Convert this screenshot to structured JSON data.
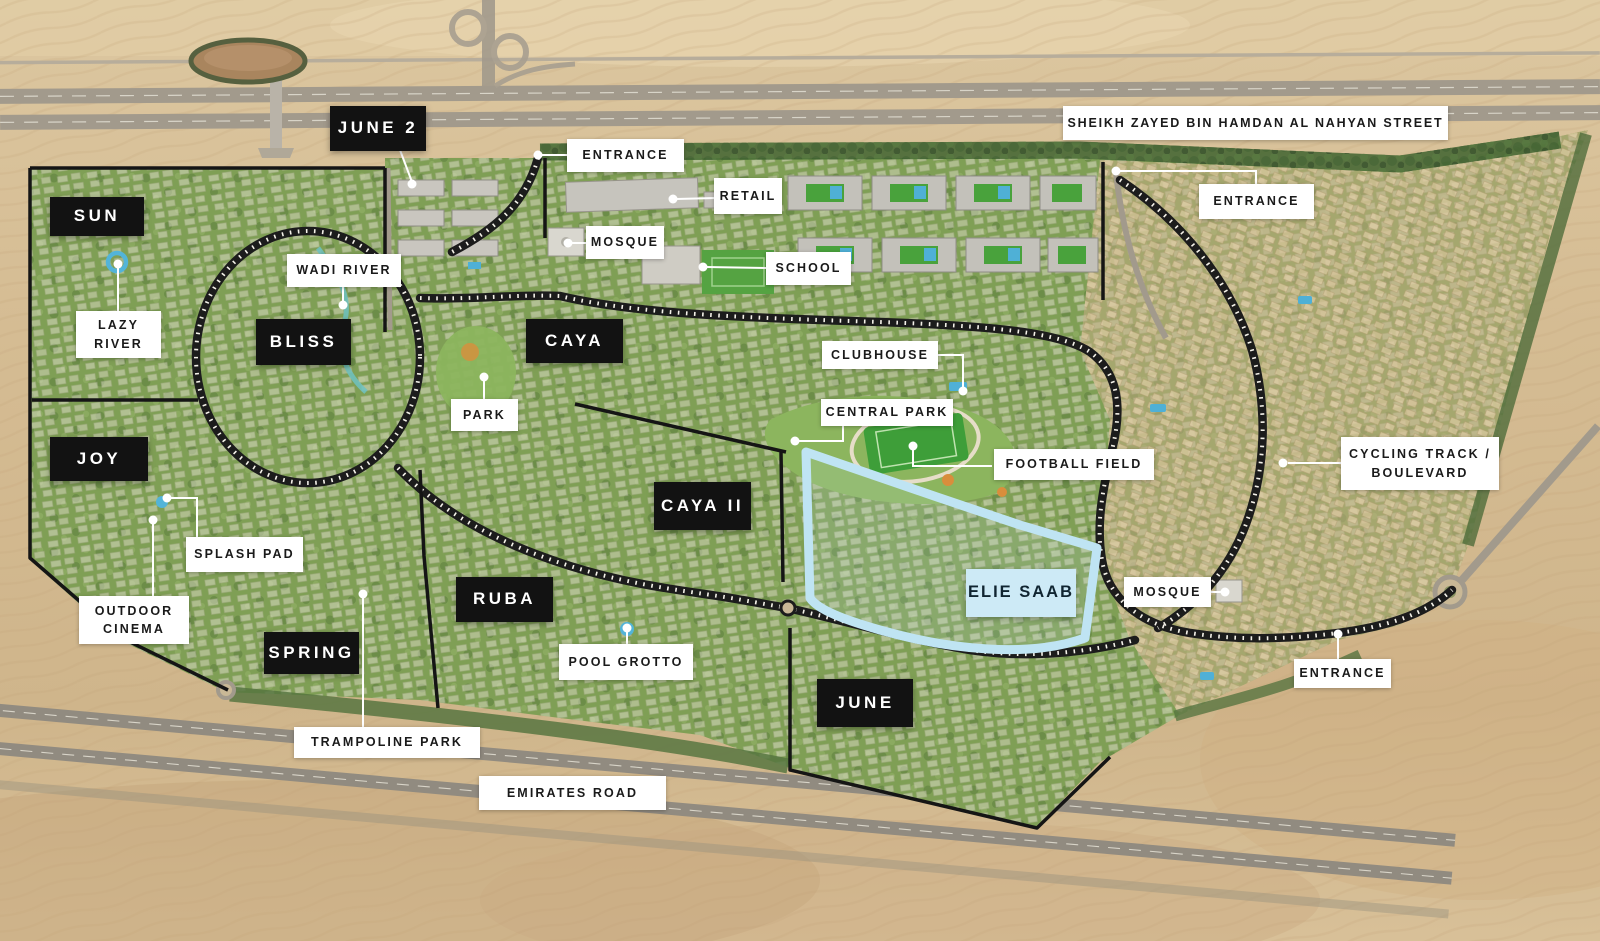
{
  "districts": {
    "june2": "JUNE 2",
    "sun": "SUN",
    "bliss": "BLISS",
    "joy": "JOY",
    "caya": "CAYA",
    "caya_ii": "CAYA II",
    "ruba": "RUBA",
    "spring": "SPRING",
    "june": "JUNE",
    "elie_saab": "ELIE SAAB"
  },
  "amenities": {
    "entrance_top": "ENTRANCE",
    "retail": "RETAIL",
    "mosque_top": "MOSQUE",
    "school": "SCHOOL",
    "entrance_top_right": "ENTRANCE",
    "wadi_river": "WADI RIVER",
    "lazy_river": {
      "line1": "LAZY",
      "line2": "RIVER"
    },
    "park": "PARK",
    "clubhouse": "CLUBHOUSE",
    "central_park": "CENTRAL PARK",
    "football_field": "FOOTBALL FIELD",
    "splash_pad": "SPLASH PAD",
    "outdoor_cinema": {
      "line1": "OUTDOOR",
      "line2": "CINEMA"
    },
    "pool_grotto": "POOL GROTTO",
    "trampoline_park": "TRAMPOLINE PARK",
    "mosque_right": "MOSQUE",
    "entrance_right": "ENTRANCE",
    "cycling_track": {
      "line1": "CYCLING TRACK /",
      "line2": "BOULEVARD"
    }
  },
  "roads": {
    "sheikh_zayed": "SHEIKH ZAYED BIN HAMDAN AL NAHYAN STREET",
    "emirates_road": "EMIRATES ROAD"
  },
  "colors": {
    "desert_sand": "#d7bf98",
    "community_green": "#7f9f55",
    "district_label_bg": "#121212",
    "district_label_text": "#ffffff",
    "amenity_label_bg": "#ffffff",
    "amenity_label_text": "#1a1a1a",
    "elie_saab_highlight": "#c9e9f6",
    "road_gray": "#a29a8c",
    "water_blue": "#53b4d8",
    "boundary_black": "#151515"
  }
}
